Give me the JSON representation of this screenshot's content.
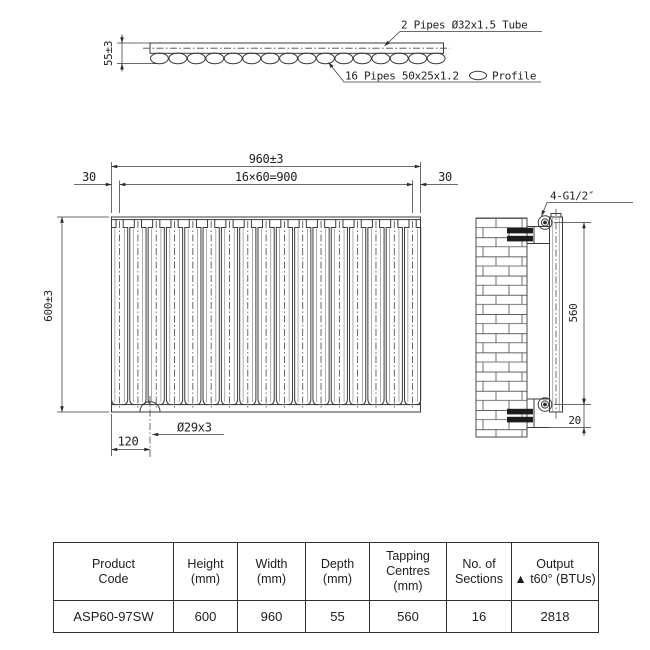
{
  "colors": {
    "ink": "#2b2b2b",
    "background": "#ffffff"
  },
  "drawing": {
    "top_view": {
      "depth_dim": "55±3",
      "tube_label": "2 Pipes Ø32x1.5 Tube",
      "profile_label_left": "16 Pipes 50x25x1.2",
      "profile_label_right": "Profile",
      "profile_icon": "oval-profile-icon"
    },
    "front_view": {
      "width_dim": "960±3",
      "pitch_dim": "16×60=900",
      "margin_left_dim": "30",
      "margin_right_dim": "30",
      "height_dim": "600±3",
      "offset_dim": "120",
      "hole_dim": "Ø29x3"
    },
    "side_view": {
      "connection_label": "4-G1/2″",
      "centres_dim": "560",
      "bottom_dim": "20"
    }
  },
  "table": {
    "headers": [
      [
        "Product",
        "Code"
      ],
      [
        "Height",
        "(mm)"
      ],
      [
        "Width",
        "(mm)"
      ],
      [
        "Depth",
        "(mm)"
      ],
      [
        "Tapping",
        "Centres",
        "(mm)"
      ],
      [
        "No. of",
        "Sections"
      ],
      [
        "Output",
        "▲ t60° (BTUs)"
      ]
    ],
    "row": [
      "ASP60-97SW",
      "600",
      "960",
      "55",
      "560",
      "16",
      "2818"
    ]
  }
}
